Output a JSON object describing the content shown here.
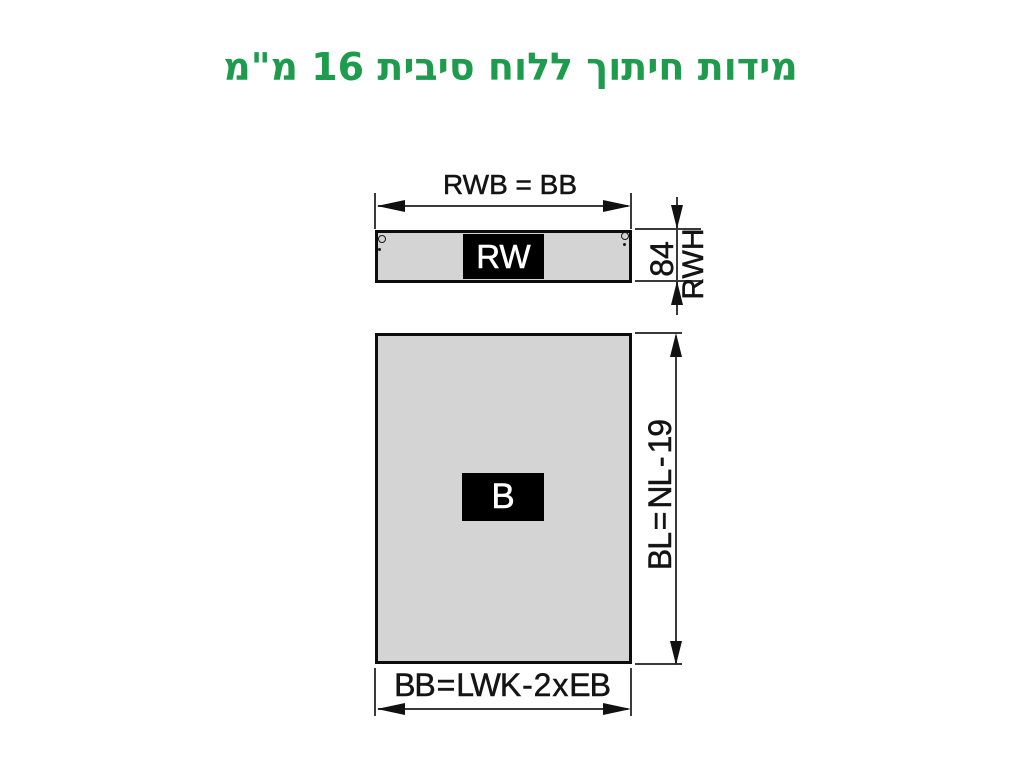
{
  "title": "מידות חיתוך ללוח סיבית 16 מ\"מ",
  "colors": {
    "title_green": "#1E9B4D",
    "panel_fill": "#D4D4D4",
    "outline": "#0d0d0d",
    "dimension_line": "#3a3a3a",
    "label_box": "#000000",
    "label_text": "#FFFFFF"
  },
  "rail_panel": {
    "label": "RW",
    "width_dimension": "RWB = BB",
    "height_value": "84",
    "height_dimension": "RWH"
  },
  "body_panel": {
    "label": "B",
    "height_dimension": "BL = NL - 19",
    "width_dimension": "BB = LWK - 2 x EB"
  }
}
